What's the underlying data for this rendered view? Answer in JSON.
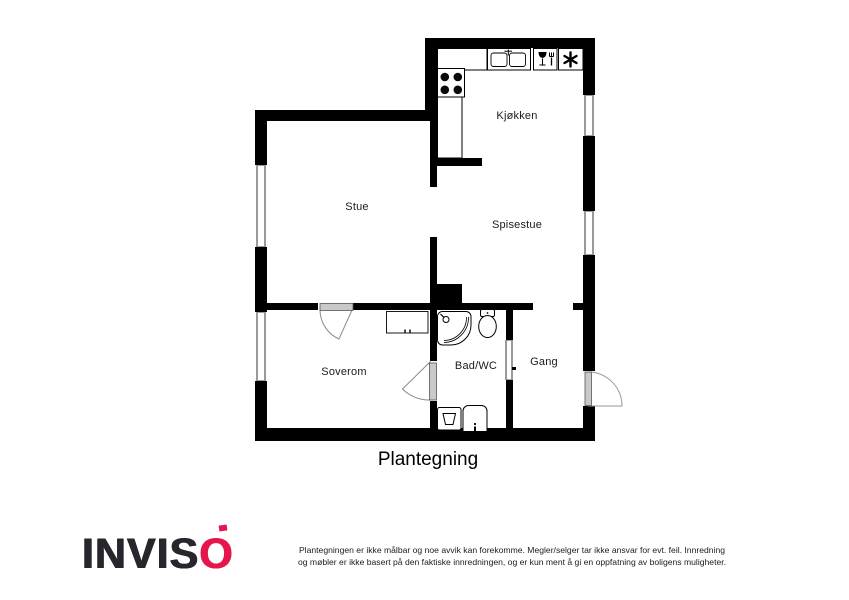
{
  "plan": {
    "title": "Plantegning",
    "rooms": {
      "kjokken": "Kjøkken",
      "stue": "Stue",
      "spisestue": "Spisestue",
      "soverom": "Soverom",
      "bad": "Bad/WC",
      "gang": "Gang"
    },
    "fixtures": {
      "stove": "stove-burners-icon",
      "sink": "double-sink-icon",
      "dishwasher": "wineglass-fork-icon",
      "freezer": "asterisk-icon",
      "shower": "shower-icon",
      "toilet": "toilet-icon",
      "washing_machine": "washing-machine-icon",
      "washbasin": "washbasin-icon",
      "cabinet": "cabinet-icon"
    },
    "colors": {
      "wall": "#000000",
      "window": "#9a9a9a",
      "door": "#c0c0c0"
    }
  },
  "footer": {
    "brand_prefix": "INVIS",
    "brand_suffix": "O",
    "brand_dark": "#29252c",
    "brand_red": "#e5164b",
    "disclaimer_line1": "Plantegningen er ikke målbar og noe avvik kan forekomme. Megler/selger tar ikke ansvar for evt. feil. Innredning",
    "disclaimer_line2": "og møbler er ikke basert på den faktiske innredningen, og er kun ment å gi en oppfatning av boligens muligheter."
  }
}
